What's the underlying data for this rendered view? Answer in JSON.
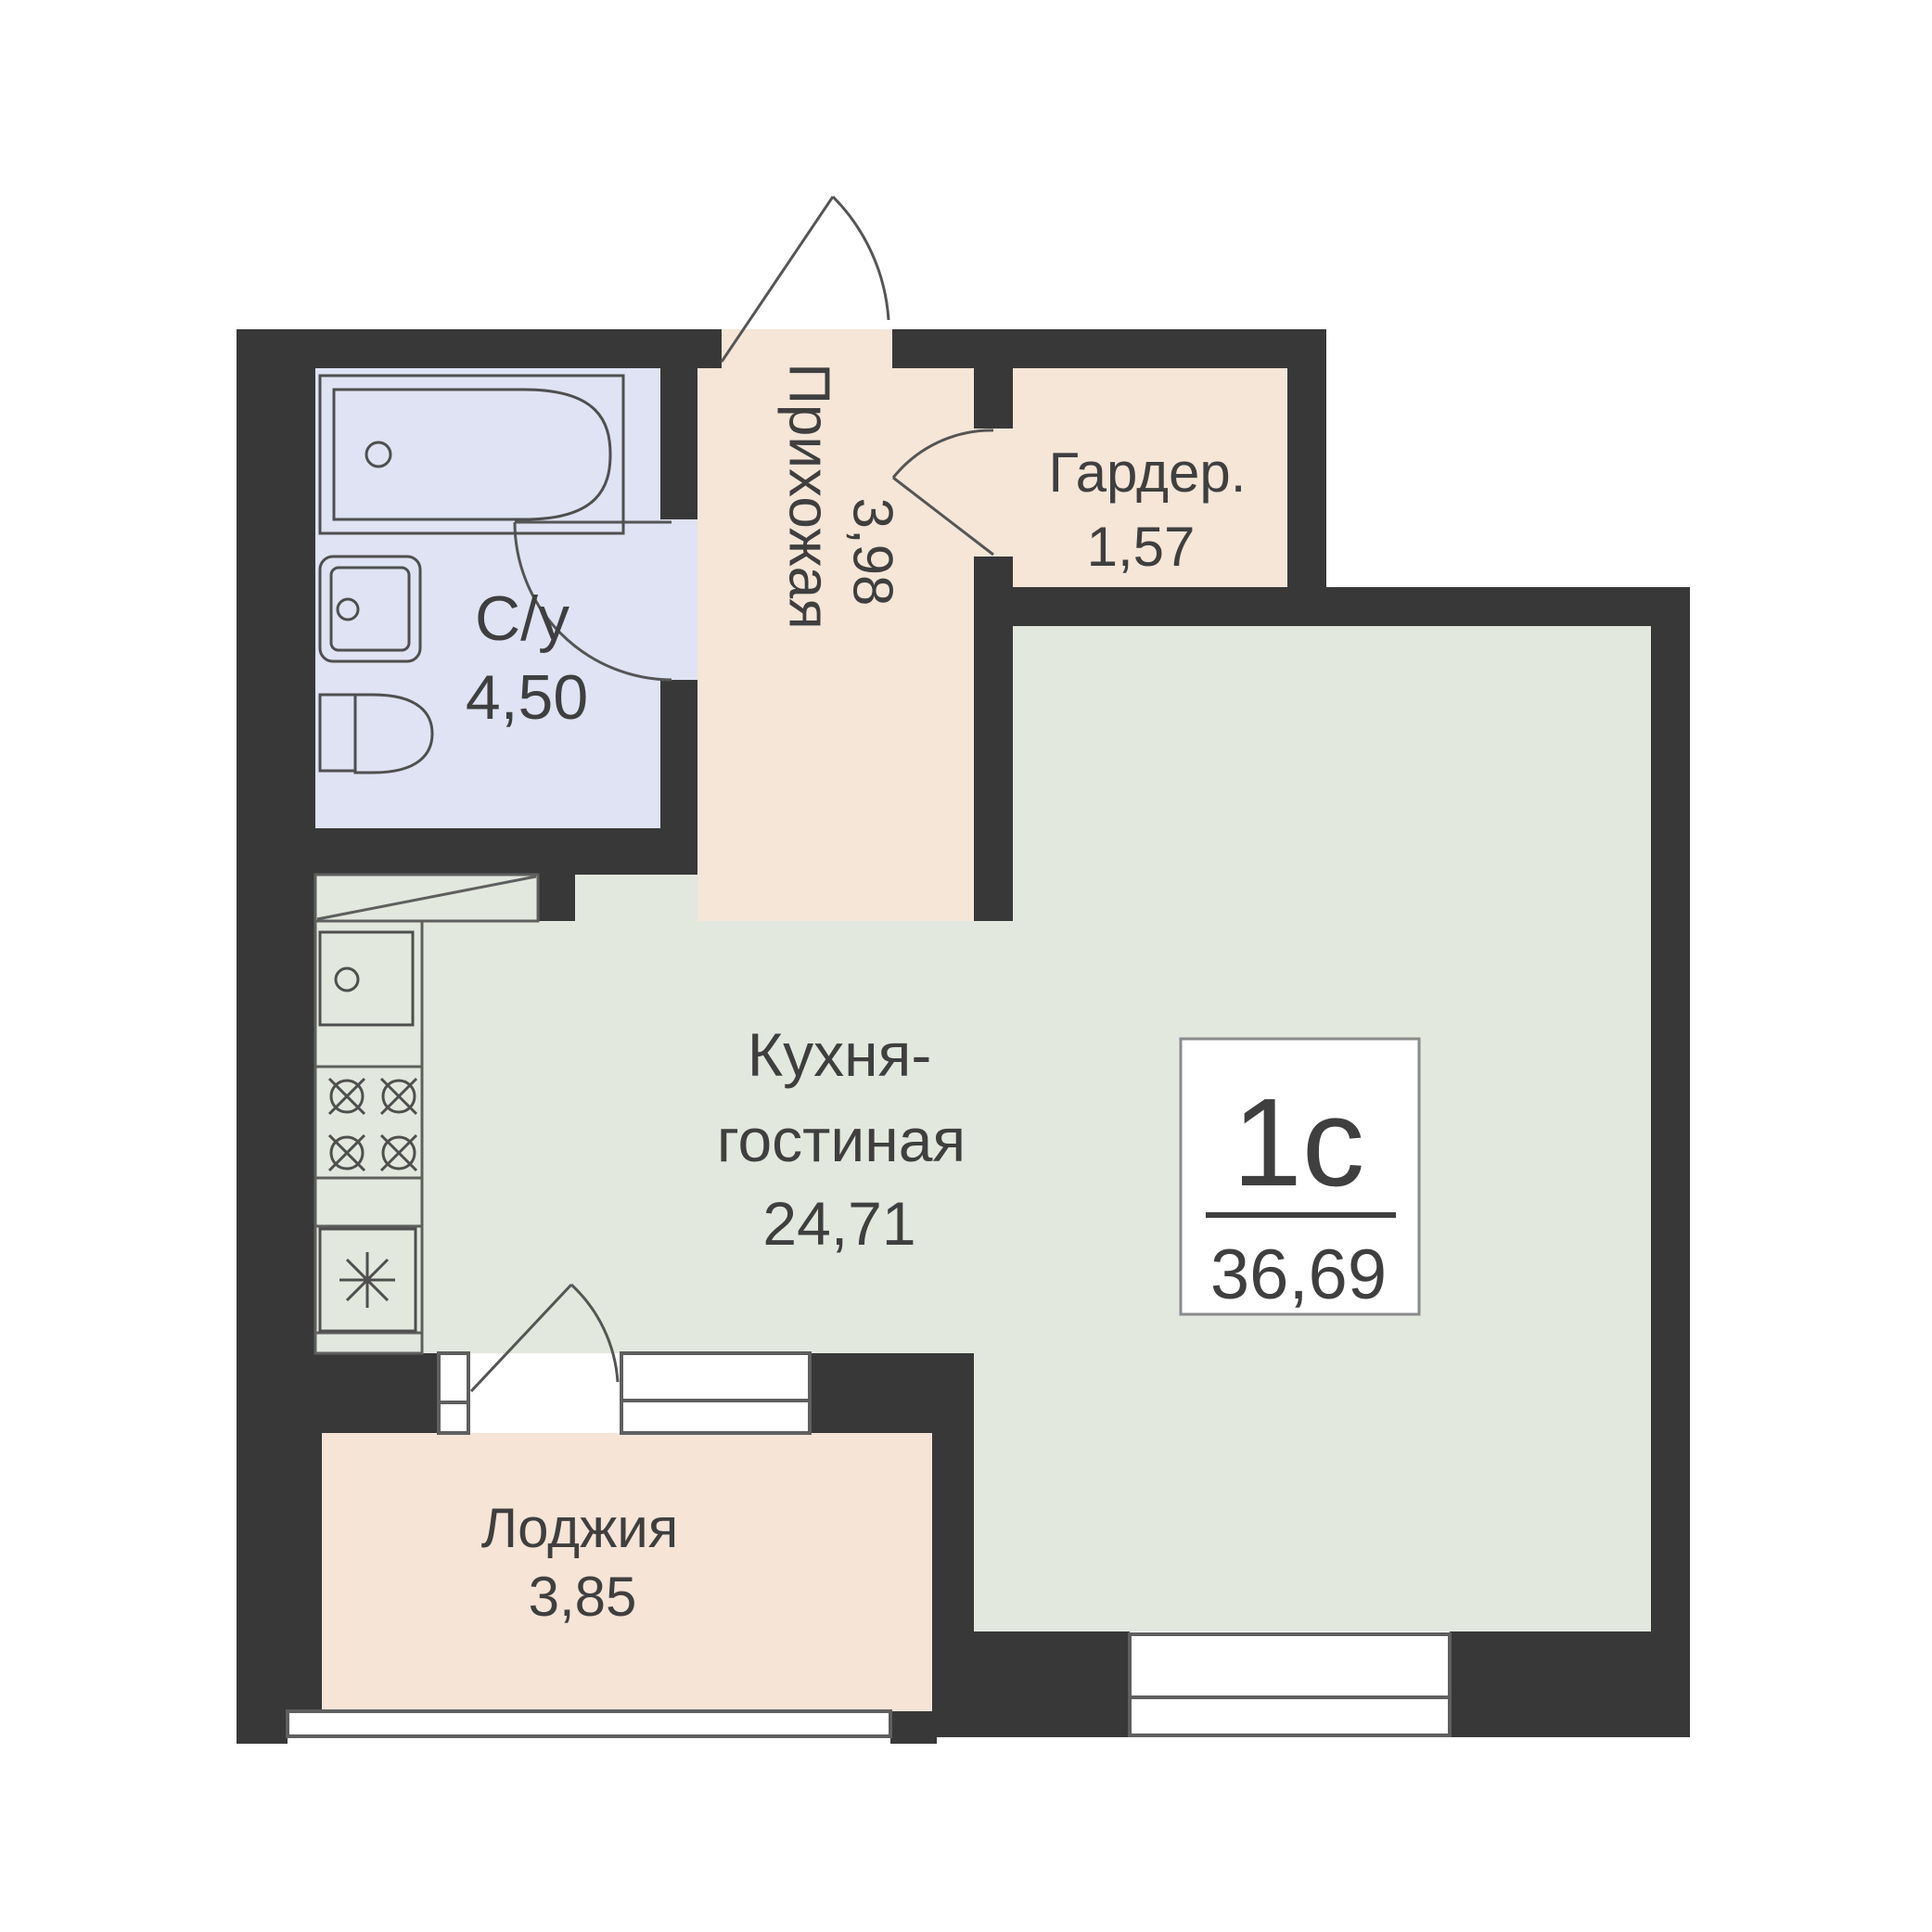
{
  "plan": {
    "title": "Floor plan of studio apartment",
    "unit_badge": {
      "type_label": "1с",
      "area_value": "36,69"
    },
    "rooms": {
      "bathroom": {
        "name": "С/у",
        "area": "4,50"
      },
      "hallway": {
        "name": "Прихожая",
        "area": "3,98"
      },
      "wardrobe": {
        "name": "Гардер.",
        "area": "1,57"
      },
      "kitchen_living": {
        "name_line1": "Кухня-",
        "name_line2": "гостиная",
        "area": "24,71"
      },
      "loggia": {
        "name": "Лоджия",
        "area": "3,85"
      }
    },
    "colors": {
      "wall": "#383838",
      "bathroom_floor": "#dfe3f3",
      "hallway_floor": "#f5e6d8",
      "wardrobe_floor": "#f5e6d8",
      "loggia_floor": "#f6e4d7",
      "living_floor": "#e2e8dd",
      "duct_fill": "#e2e8dd",
      "badge_bg": "#ffffff",
      "text": "#3f3f3f"
    }
  }
}
